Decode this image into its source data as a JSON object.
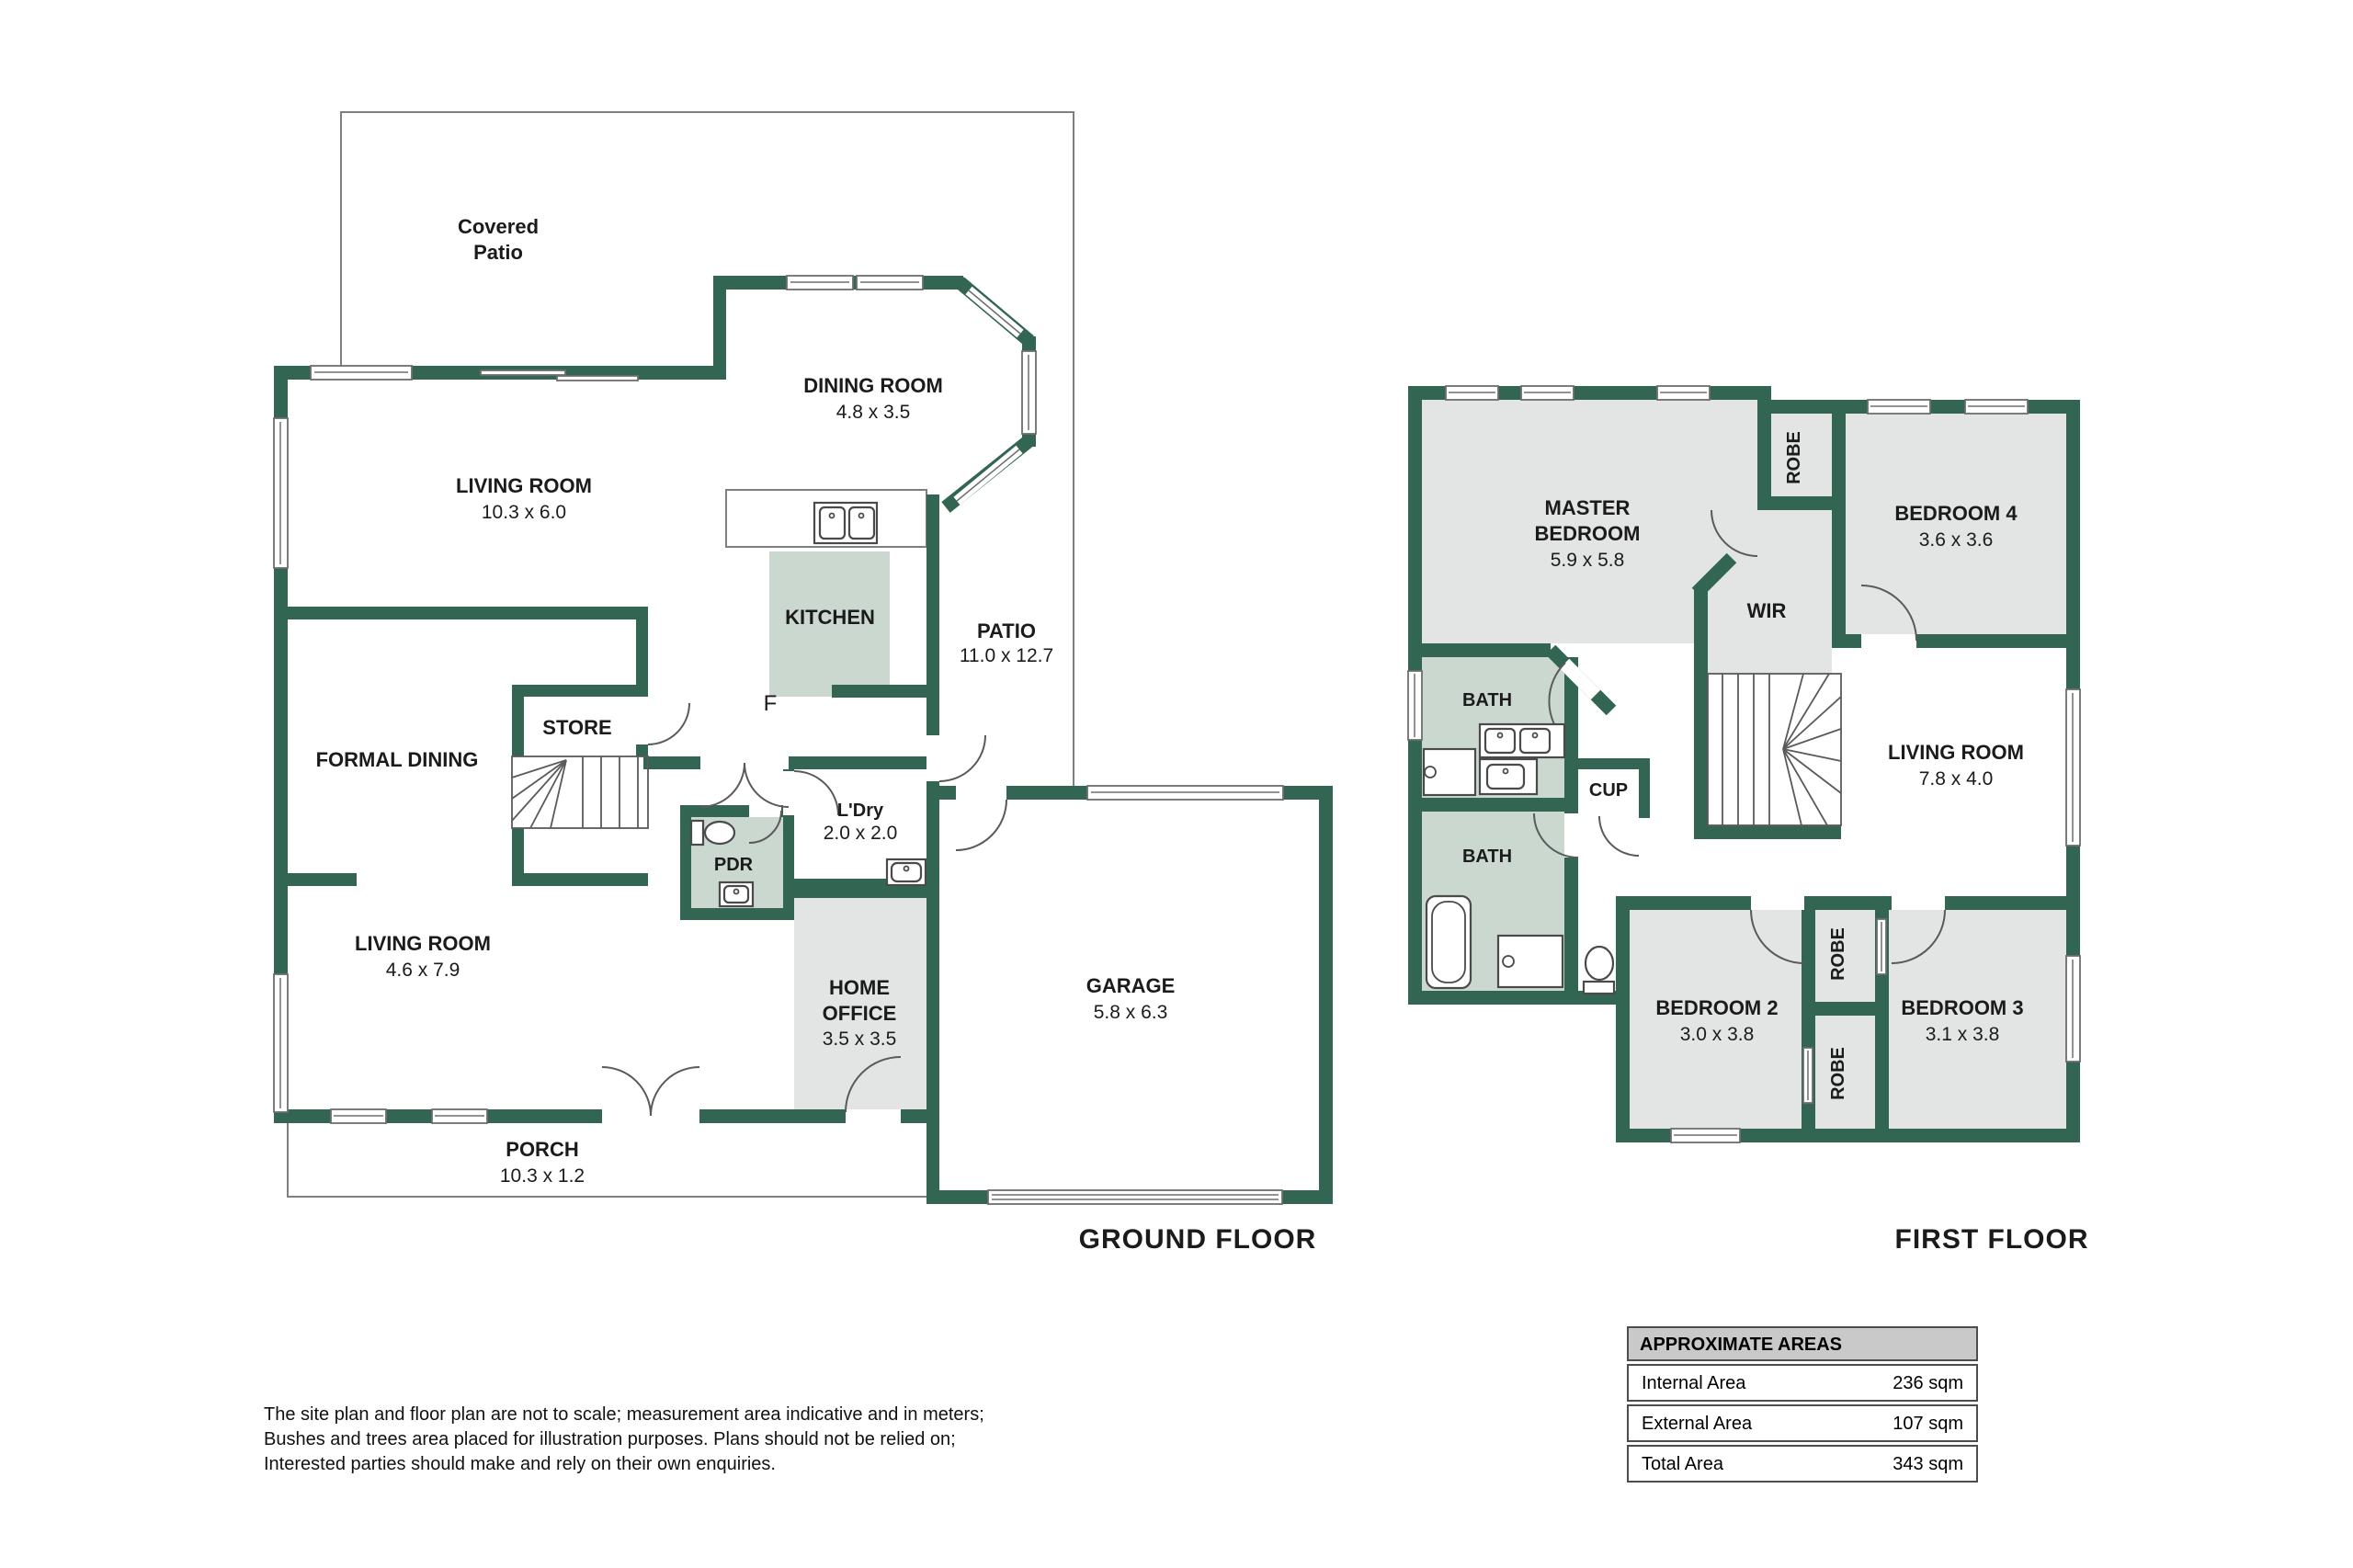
{
  "colors": {
    "wall_green": "#336652",
    "room_gray": "#E3E5E4",
    "room_sage": "#CBD8D0",
    "table_header_bg": "#C9C9C9",
    "outline_gray": "#7F7F7F"
  },
  "floors": {
    "ground": {
      "title": "GROUND FLOOR",
      "rooms": {
        "covered_patio": {
          "line1": "Covered",
          "line2": "Patio"
        },
        "living_room_rear": {
          "name": "LIVING ROOM",
          "dims": "10.3 x 6.0"
        },
        "dining_room": {
          "name": "DINING ROOM",
          "dims": "4.8 x 3.5"
        },
        "kitchen": {
          "name": "KITCHEN"
        },
        "fridge": {
          "label": "F"
        },
        "patio": {
          "name": "PATIO",
          "dims": "11.0 x 12.7"
        },
        "store": {
          "name": "STORE"
        },
        "formal_dining": {
          "name": "FORMAL DINING"
        },
        "laundry": {
          "name": "L'Dry",
          "dims": "2.0 x 2.0"
        },
        "powder_room": {
          "name": "PDR"
        },
        "living_room_front": {
          "name": "LIVING ROOM",
          "dims": "4.6 x 7.9"
        },
        "home_office": {
          "line1": "HOME",
          "line2": "OFFICE",
          "dims": "3.5 x 3.5"
        },
        "garage": {
          "name": "GARAGE",
          "dims": "5.8 x 6.3"
        },
        "porch": {
          "name": "PORCH",
          "dims": "10.3 x 1.2"
        }
      }
    },
    "first": {
      "title": "FIRST FLOOR",
      "rooms": {
        "master_bedroom": {
          "line1": "MASTER",
          "line2": "BEDROOM",
          "dims": "5.9 x 5.8"
        },
        "robe_master": {
          "name": "ROBE"
        },
        "bedroom4": {
          "name": "BEDROOM 4",
          "dims": "3.6 x 3.6"
        },
        "wir": {
          "name": "WIR"
        },
        "living_room": {
          "name": "LIVING ROOM",
          "dims": "7.8 x 4.0"
        },
        "bath_ensuite": {
          "name": "BATH"
        },
        "bath_main": {
          "name": "BATH"
        },
        "cupboard": {
          "name": "CUP"
        },
        "bedroom2": {
          "name": "BEDROOM 2",
          "dims": "3.0 x 3.8"
        },
        "bedroom3": {
          "name": "BEDROOM 3",
          "dims": "3.1 x 3.8"
        },
        "robe_bedroom3": {
          "name": "ROBE"
        },
        "robe_bedroom2": {
          "name": "ROBE"
        }
      }
    }
  },
  "areas_table": {
    "header": "APPROXIMATE AREAS",
    "rows": [
      {
        "label": "Internal Area",
        "value": "236 sqm"
      },
      {
        "label": "External Area",
        "value": "107 sqm"
      },
      {
        "label": "Total Area",
        "value": "343 sqm"
      }
    ]
  },
  "disclaimer": {
    "line1": "The site plan and floor plan are not to scale; measurement area indicative and in meters;",
    "line2": "Bushes and trees area placed for illustration purposes. Plans should not be relied on;",
    "line3": "Interested parties should make and rely on their own enquiries."
  }
}
